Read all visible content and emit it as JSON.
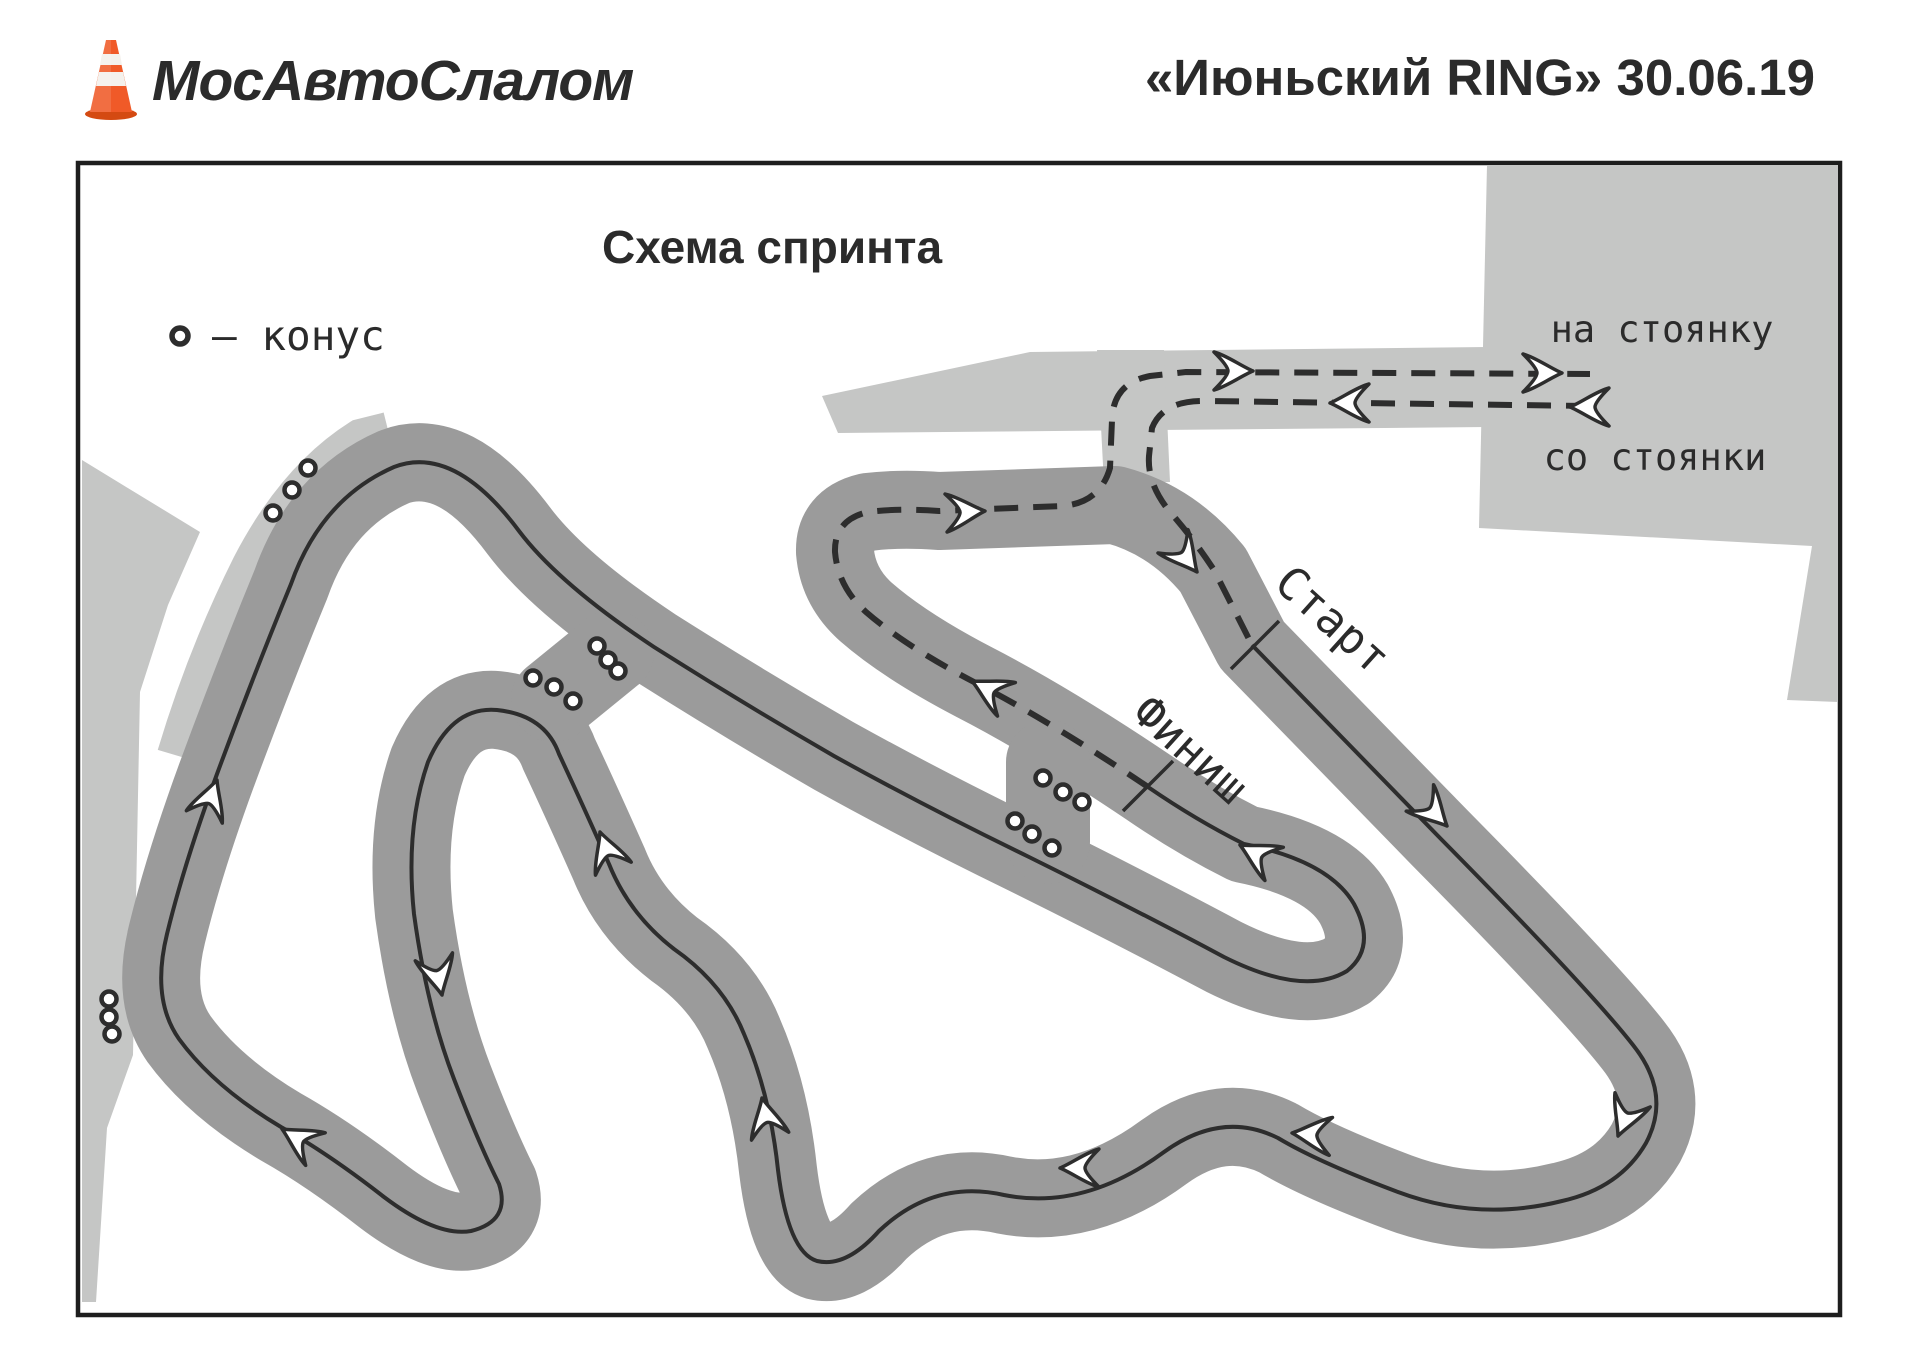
{
  "header": {
    "logo_text": "МосАвтоСлалом",
    "event_title": "«Июньский RING» 30.06.19"
  },
  "map": {
    "title": "Схема спринта",
    "legend_label": "– конус",
    "start_label": "Старт",
    "finish_label": "Финиш",
    "to_parking_label": "на стоянку",
    "from_parking_label": "со стоянки"
  },
  "colors": {
    "track": "#9b9b9b",
    "apron": "#c5c6c5",
    "line": "#2d2d2d",
    "border": "#1e1e1e",
    "text": "#2b2b2b",
    "cone_orange": "#f05a28"
  }
}
